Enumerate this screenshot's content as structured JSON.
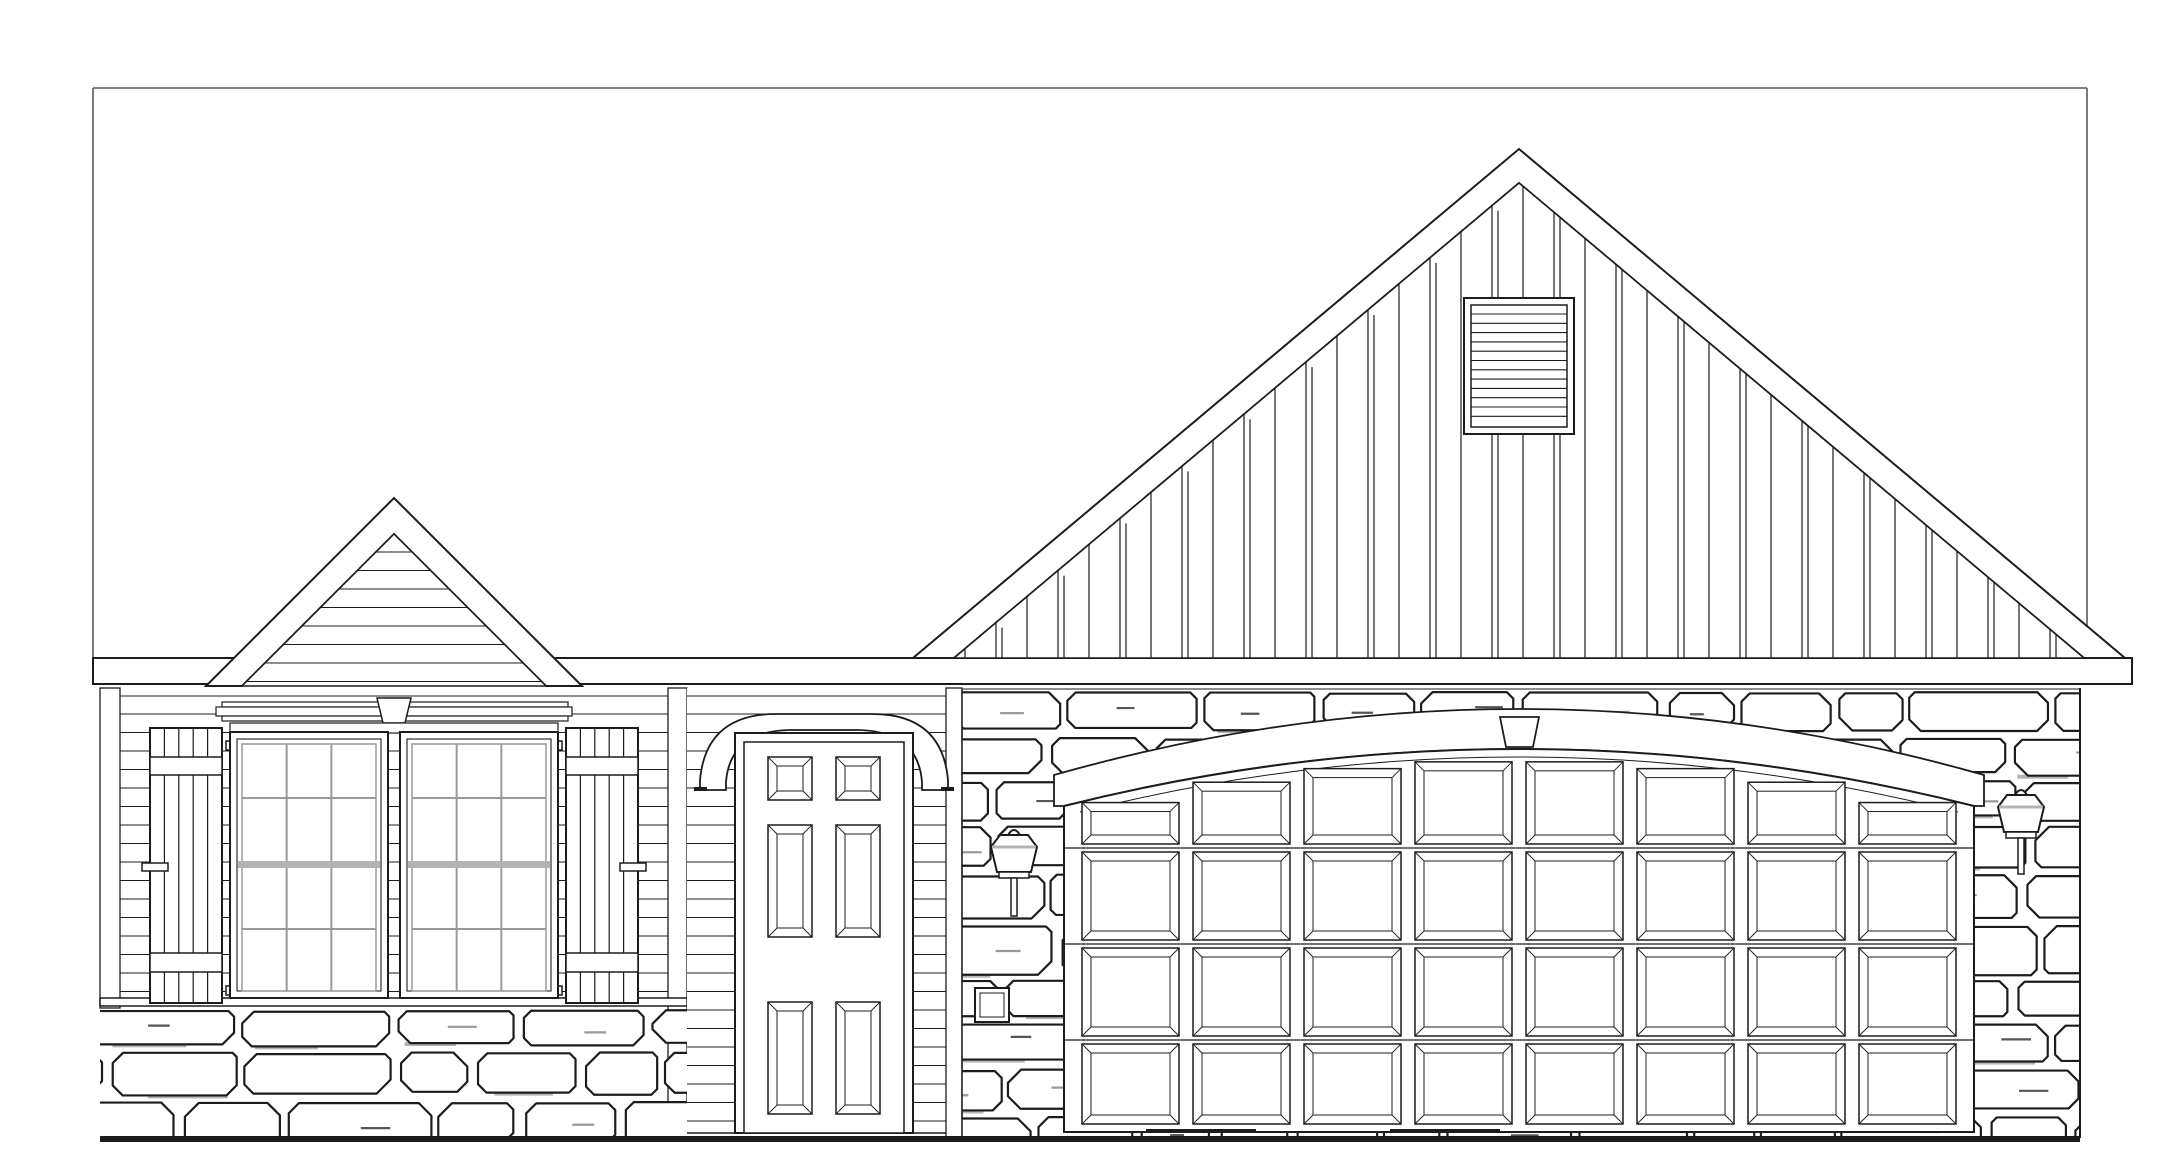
{
  "page": {
    "title": "Front elevation line drawing — single-story house with two-car garage",
    "background": "#ffffff"
  },
  "palette": {
    "paper": "#ffffff",
    "ink": "#1c1c1c",
    "soft_grey": "#9a9a9a",
    "mortar_grey": "#b4b4b4",
    "rail_grey": "#b3b3b3",
    "border_grey": "#5a5a5a"
  },
  "sheet": {
    "border_sides_visible": [
      "top",
      "left",
      "right"
    ]
  },
  "elements": {
    "eave_band": {
      "label": "horizontal fascia / eave band"
    },
    "left_gable": {
      "label": "secondary gable with horizontal lap siding",
      "siding_line_step": 18.5
    },
    "main_gable": {
      "label": "main gable with board-and-batten siding",
      "batten_step": 31,
      "vent": {
        "label": "louvered gable vent",
        "louver_count": 12
      }
    },
    "window_unit": {
      "label": "paired double-hung windows with shutters",
      "window_count": 2,
      "grid_columns": 3,
      "grid_rows": 4,
      "cornice": {
        "label": "crown header with keystone"
      },
      "shutters": {
        "count": 2,
        "boards_per_shutter": 5,
        "rails_per_shutter": 2,
        "dogs_per_shutter": 2
      }
    },
    "front_door": {
      "label": "six-panel entry door with arched trim",
      "panel_count": 6
    },
    "garage_door": {
      "label": "carriage-style garage door",
      "panel_columns": 8,
      "panel_rows": 4,
      "header": {
        "label": "arched trim band with keystone"
      }
    },
    "lanterns": {
      "count": 2,
      "label": "wall lanterns"
    },
    "utility_box": {
      "label": "wall-mounted utility box"
    },
    "stone": {
      "label": "random ashlar stone veneer",
      "seed": 7,
      "row_height_min": 40,
      "row_height_max": 54
    },
    "siding": {
      "line_step": 18.5
    },
    "ground_line": {
      "label": "grade line",
      "thickness": 6
    }
  }
}
